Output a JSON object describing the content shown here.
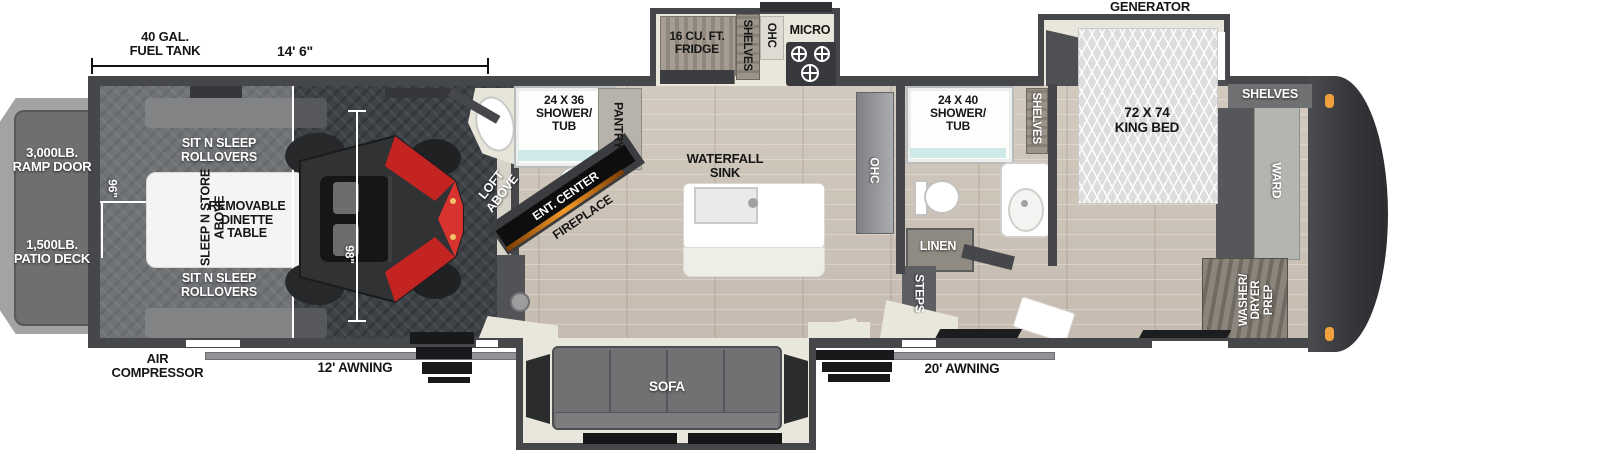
{
  "diagram": {
    "type": "RV fifth wheel toy hauler floor plan",
    "colors": {
      "wall": "#46474b",
      "wood_floor": "#cbc2b7",
      "garage_floor": "#3e4247",
      "marker_light_orange": "#f0a03c",
      "fireplace_glow": "#f59a28",
      "atv_red": "#c32421",
      "deck_gray": "#6e6f70"
    },
    "dimensions": {
      "garage_length": "14' 6\"",
      "fuel_tank": "40 GAL.\nFUEL TANK",
      "garage_width": "96\"",
      "garage_interior_length": "98\""
    },
    "exterior": {
      "ramp_door": "3,000LB.\nRAMP DOOR",
      "patio_deck": "1,500LB.\nPATIO DECK",
      "air_compressor": "AIR\nCOMPRESSOR",
      "awning_rear": "12' AWNING",
      "awning_front": "20' AWNING",
      "generator_prep": "GENERATOR\nPREP"
    },
    "garage": {
      "rollover_sofa_top": "SIT N SLEEP\nROLLOVERS",
      "rollover_sofa_bottom": "SIT N SLEEP\nROLLOVERS",
      "overhead_bed": "SLEEP N STORE\nABOVE",
      "dinette": "REMOVABLE\nDINETTE\nTABLE",
      "loft": "LOFT\nABOVE"
    },
    "half_bath": {
      "shower": "24 X 36\nSHOWER/\nTUB",
      "pantry": "PANTRY"
    },
    "living": {
      "ent_center": "ENT. CENTER",
      "fireplace": "FIREPLACE",
      "island": "WATERFALL\nSINK",
      "counter_ohc": "OHC",
      "sofa": "SOFA"
    },
    "kitchen": {
      "fridge": "16 CU. FT.\nFRIDGE",
      "shelves": "SHELVES",
      "ohc": "OHC",
      "micro": "MICRO"
    },
    "bathroom": {
      "shower": "24 X 40\nSHOWER/\nTUB",
      "shelves": "SHELVES",
      "linen": "LINEN",
      "steps": "STEPS"
    },
    "bedroom": {
      "bed": "72 X 74\nKING BED",
      "shelves": "SHELVES",
      "ward": "WARD",
      "washer_dryer": "WASHER/\nDRYER\nPREP"
    }
  }
}
